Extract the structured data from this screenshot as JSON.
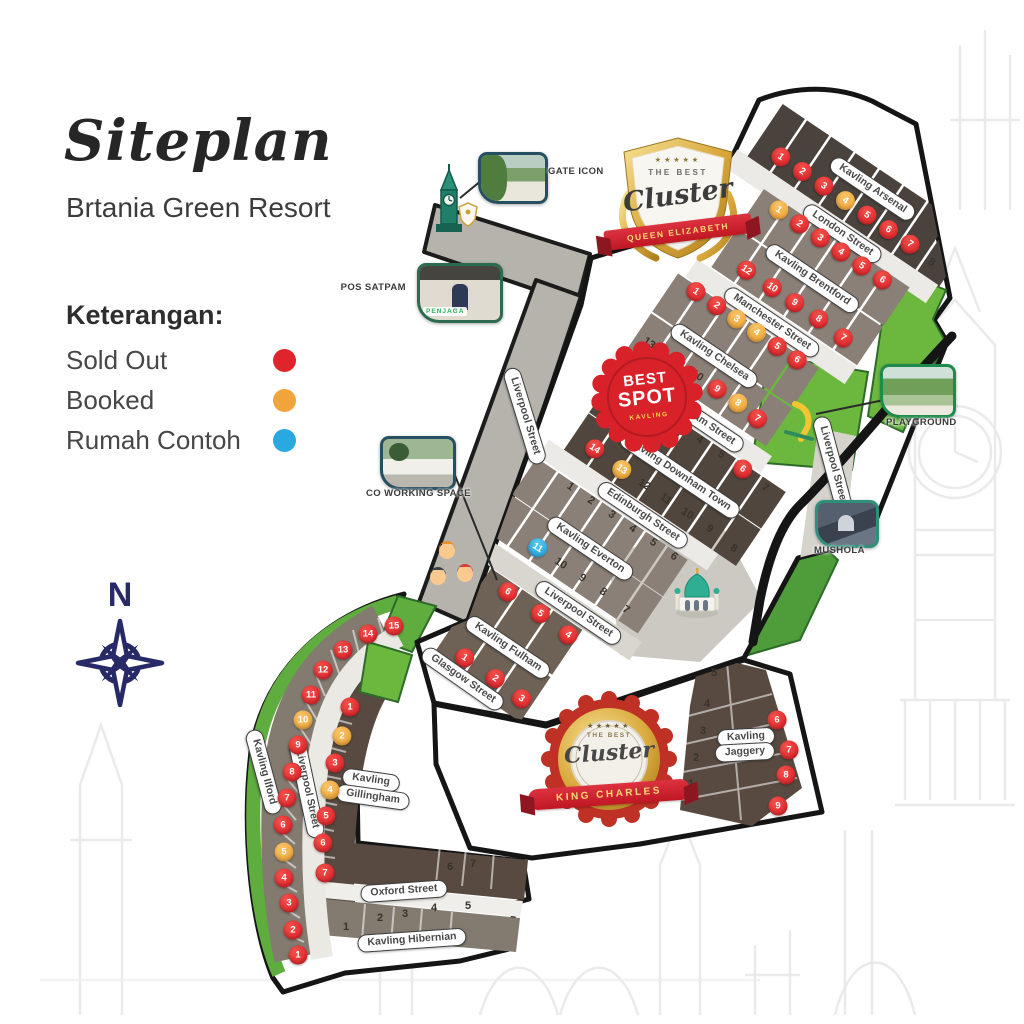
{
  "header": {
    "title": "Siteplan",
    "subtitle": "Brtania Green Resort"
  },
  "legend": {
    "heading": "Keterangan:",
    "items": [
      {
        "label": "Sold Out",
        "status": "sold",
        "color": "#e0242c"
      },
      {
        "label": "Booked",
        "status": "booked",
        "color": "#f1a33c"
      },
      {
        "label": "Rumah Contoh",
        "status": "contoh",
        "color": "#29a9e0"
      }
    ]
  },
  "compass": {
    "north": "N"
  },
  "badges": {
    "queen_elizabeth": {
      "stars": "★★★★★",
      "top_text": "THE BEST",
      "script_text": "Cluster",
      "ribbon_text": "QUEEN ELIZABETH"
    },
    "best_spot": {
      "line1": "BEST",
      "line2": "SPOT",
      "line3": "KAVLING"
    },
    "king_charles": {
      "stars": "★★★★★",
      "top_text": "THE BEST",
      "script_text": "Cluster",
      "ribbon_text": "KING CHARLES"
    }
  },
  "poi": {
    "gate": {
      "label": "GATE ICON"
    },
    "pos_satpam": {
      "label": "POS SATPAM",
      "sign": "PENJAGA"
    },
    "coworking": {
      "label": "CO WORKING SPACE"
    },
    "playground": {
      "label": "PLAYGROUND"
    },
    "mushola": {
      "label": "MUSHOLA"
    }
  },
  "map": {
    "streets": [
      {
        "label": "Kavling Arsenal",
        "frame": "qe",
        "x": 150,
        "y": 12,
        "rot": 0
      },
      {
        "label": "London Street",
        "frame": "qe",
        "x": 150,
        "y": 66,
        "rot": 0
      },
      {
        "label": "Kavling Brentford",
        "frame": "qe",
        "x": 150,
        "y": 120,
        "rot": 0
      },
      {
        "label": "Manchester Street",
        "frame": "qe",
        "x": 141,
        "y": 179,
        "rot": 0
      },
      {
        "label": "Kavling Chelsea",
        "frame": "qe",
        "x": 112,
        "y": 239,
        "rot": 0
      },
      {
        "label": "Birmingham Street",
        "frame": "qe",
        "x": 130,
        "y": 300,
        "rot": 0
      },
      {
        "label": "Kavling Downham Town",
        "frame": "qe",
        "x": 150,
        "y": 357,
        "rot": 0
      },
      {
        "label": "Edinburgh Street",
        "frame": "qe",
        "x": 142,
        "y": 411,
        "rot": 0
      },
      {
        "label": "Kavling Everton",
        "frame": "qe",
        "x": 117,
        "y": 468,
        "rot": 0
      },
      {
        "label": "Liverpool Street",
        "frame": "qe",
        "x": 143,
        "y": 528,
        "rot": 0
      },
      {
        "label": "Kavling Fulham",
        "frame": "qe",
        "x": 104,
        "y": 596,
        "rot": 0
      },
      {
        "label": "Glasgow Street",
        "frame": "abs",
        "x": 463,
        "y": 679,
        "rot": 35
      },
      {
        "label": "Liverpool Street",
        "frame": "abs",
        "x": 525,
        "y": 416,
        "rot": 73
      },
      {
        "label": "Liverpool Street",
        "frame": "abs",
        "x": 833,
        "y": 465,
        "rot": 75
      },
      {
        "label": "Kavling Ilford",
        "frame": "abs",
        "x": 264,
        "y": 772,
        "rot": 75
      },
      {
        "label": "Liverpool Street",
        "frame": "abs",
        "x": 307,
        "y": 789,
        "rot": 78
      },
      {
        "label": "Kavling",
        "frame": "abs",
        "x": 371,
        "y": 780,
        "rot": 8
      },
      {
        "label": "Gillingham",
        "frame": "abs",
        "x": 373,
        "y": 797,
        "rot": 8
      },
      {
        "label": "Oxford Street",
        "frame": "abs",
        "x": 404,
        "y": 891,
        "rot": -4
      },
      {
        "label": "Kavling Hibernian",
        "frame": "abs",
        "x": 412,
        "y": 940,
        "rot": -4
      },
      {
        "label": "Kavling",
        "frame": "abs",
        "x": 746,
        "y": 737,
        "rot": -3
      },
      {
        "label": "Jaggery",
        "frame": "abs",
        "x": 745,
        "y": 752,
        "rot": -3
      }
    ],
    "plot_groups": [
      {
        "id": "arsenal",
        "kavling": "Kavling Arsenal",
        "frame": "qe",
        "markers": [
          {
            "n": "1",
            "s": "sold",
            "x": 56,
            "y": 37
          },
          {
            "n": "2",
            "s": "sold",
            "x": 82,
            "y": 37
          },
          {
            "n": "3",
            "s": "sold",
            "x": 108,
            "y": 37
          },
          {
            "n": "4",
            "s": "booked",
            "x": 134,
            "y": 37
          },
          {
            "n": "5",
            "s": "sold",
            "x": 160,
            "y": 37
          },
          {
            "n": "6",
            "s": "sold",
            "x": 186,
            "y": 37
          },
          {
            "n": "7",
            "s": "sold",
            "x": 212,
            "y": 37
          },
          {
            "n": "8",
            "s": "open",
            "x": 240,
            "y": 40
          }
        ]
      },
      {
        "id": "brentford",
        "kavling": "Kavling Brentford",
        "frame": "qe",
        "markers": [
          {
            "n": "1",
            "s": "booked",
            "x": 84,
            "y": 82
          },
          {
            "n": "2",
            "s": "sold",
            "x": 109,
            "y": 82
          },
          {
            "n": "3",
            "s": "sold",
            "x": 134,
            "y": 82
          },
          {
            "n": "4",
            "s": "sold",
            "x": 159,
            "y": 82
          },
          {
            "n": "5",
            "s": "sold",
            "x": 184,
            "y": 82
          },
          {
            "n": "6",
            "s": "sold",
            "x": 209,
            "y": 82
          },
          {
            "n": "12",
            "s": "sold",
            "x": 91,
            "y": 150
          },
          {
            "n": "10",
            "s": "sold",
            "x": 122,
            "y": 150
          },
          {
            "n": "9",
            "s": "sold",
            "x": 149,
            "y": 150
          },
          {
            "n": "8",
            "s": "sold",
            "x": 178,
            "y": 150
          },
          {
            "n": "7",
            "s": "sold",
            "x": 209,
            "y": 152
          }
        ]
      },
      {
        "id": "chelsea",
        "kavling": "Kavling Chelsea",
        "frame": "qe",
        "markers": [
          {
            "n": "1",
            "s": "sold",
            "x": 61,
            "y": 196
          },
          {
            "n": "2",
            "s": "sold",
            "x": 86,
            "y": 196
          },
          {
            "n": "3",
            "s": "booked",
            "x": 110,
            "y": 196
          },
          {
            "n": "4",
            "s": "booked",
            "x": 134,
            "y": 196
          },
          {
            "n": "5",
            "s": "sold",
            "x": 159,
            "y": 196
          },
          {
            "n": "6",
            "s": "sold",
            "x": 183,
            "y": 196
          },
          {
            "n": "13",
            "s": "open",
            "x": 51,
            "y": 265
          },
          {
            "n": "10",
            "s": "open",
            "x": 109,
            "y": 265
          },
          {
            "n": "9",
            "s": "sold",
            "x": 133,
            "y": 265
          },
          {
            "n": "8",
            "s": "booked",
            "x": 158,
            "y": 265
          },
          {
            "n": "7",
            "s": "sold",
            "x": 183,
            "y": 267
          }
        ]
      },
      {
        "id": "downham",
        "kavling": "Kavling Downham Town",
        "frame": "qe",
        "markers": [
          {
            "n": "3",
            "s": "open",
            "x": 121,
            "y": 317
          },
          {
            "n": "4",
            "s": "open",
            "x": 147,
            "y": 317
          },
          {
            "n": "5",
            "s": "open",
            "x": 173,
            "y": 317
          },
          {
            "n": "6",
            "s": "sold",
            "x": 199,
            "y": 317
          },
          {
            "n": "7",
            "s": "open",
            "x": 228,
            "y": 320
          },
          {
            "n": "14",
            "s": "sold",
            "x": 65,
            "y": 383
          },
          {
            "n": "13",
            "s": "booked",
            "x": 99,
            "y": 385
          },
          {
            "n": "12",
            "s": "open",
            "x": 126,
            "y": 385
          },
          {
            "n": "11",
            "s": "open",
            "x": 152,
            "y": 385
          },
          {
            "n": "10",
            "s": "open",
            "x": 178,
            "y": 385
          },
          {
            "n": "9",
            "s": "open",
            "x": 205,
            "y": 385
          },
          {
            "n": "8",
            "s": "open",
            "x": 236,
            "y": 388
          }
        ]
      },
      {
        "id": "everton",
        "kavling": "Kavling Everton",
        "frame": "qe",
        "markers": [
          {
            "n": "1",
            "s": "open",
            "x": 66,
            "y": 428
          },
          {
            "n": "2",
            "s": "open",
            "x": 91,
            "y": 428
          },
          {
            "n": "3",
            "s": "open",
            "x": 116,
            "y": 428
          },
          {
            "n": "4",
            "s": "open",
            "x": 141,
            "y": 428
          },
          {
            "n": "5",
            "s": "open",
            "x": 166,
            "y": 428
          },
          {
            "n": "6",
            "s": "open",
            "x": 191,
            "y": 428
          },
          {
            "n": "11",
            "s": "contoh",
            "x": 73,
            "y": 497
          },
          {
            "n": "10",
            "s": "open",
            "x": 101,
            "y": 497
          },
          {
            "n": "9",
            "s": "open",
            "x": 127,
            "y": 497
          },
          {
            "n": "8",
            "s": "open",
            "x": 152,
            "y": 497
          },
          {
            "n": "7",
            "s": "open",
            "x": 181,
            "y": 499
          }
        ]
      },
      {
        "id": "fulham",
        "kavling": "Kavling Fulham",
        "frame": "qe",
        "markers": [
          {
            "n": "6",
            "s": "sold",
            "x": 73,
            "y": 550
          },
          {
            "n": "5",
            "s": "sold",
            "x": 112,
            "y": 550
          },
          {
            "n": "4",
            "s": "sold",
            "x": 147,
            "y": 552
          },
          {
            "n": "1",
            "s": "sold",
            "x": 74,
            "y": 629
          },
          {
            "n": "2",
            "s": "sold",
            "x": 111,
            "y": 629
          },
          {
            "n": "3",
            "s": "sold",
            "x": 144,
            "y": 631
          }
        ]
      },
      {
        "id": "ilford",
        "kavling": "Kavling Ilford",
        "frame": "abs",
        "markers": [
          {
            "n": "15",
            "s": "sold",
            "x": 394,
            "y": 626
          },
          {
            "n": "14",
            "s": "sold",
            "x": 368,
            "y": 634
          },
          {
            "n": "13",
            "s": "sold",
            "x": 343,
            "y": 650
          },
          {
            "n": "12",
            "s": "sold",
            "x": 323,
            "y": 670
          },
          {
            "n": "11",
            "s": "sold",
            "x": 311,
            "y": 695
          },
          {
            "n": "10",
            "s": "booked",
            "x": 303,
            "y": 720
          },
          {
            "n": "9",
            "s": "sold",
            "x": 298,
            "y": 745
          },
          {
            "n": "8",
            "s": "sold",
            "x": 292,
            "y": 772
          },
          {
            "n": "7",
            "s": "sold",
            "x": 287,
            "y": 798
          },
          {
            "n": "6",
            "s": "sold",
            "x": 283,
            "y": 825
          },
          {
            "n": "5",
            "s": "booked",
            "x": 284,
            "y": 852
          },
          {
            "n": "4",
            "s": "sold",
            "x": 284,
            "y": 878
          },
          {
            "n": "3",
            "s": "sold",
            "x": 289,
            "y": 903
          },
          {
            "n": "2",
            "s": "sold",
            "x": 293,
            "y": 930
          },
          {
            "n": "1",
            "s": "sold",
            "x": 298,
            "y": 955
          }
        ]
      },
      {
        "id": "gillingham",
        "kavling": "Kavling Gillingham",
        "frame": "abs",
        "markers": [
          {
            "n": "1",
            "s": "sold",
            "x": 350,
            "y": 707
          },
          {
            "n": "2",
            "s": "booked",
            "x": 342,
            "y": 736
          },
          {
            "n": "3",
            "s": "sold",
            "x": 335,
            "y": 763
          },
          {
            "n": "4",
            "s": "booked",
            "x": 330,
            "y": 790
          },
          {
            "n": "5",
            "s": "sold",
            "x": 326,
            "y": 816
          },
          {
            "n": "6",
            "s": "sold",
            "x": 323,
            "y": 843
          },
          {
            "n": "7",
            "s": "sold",
            "x": 325,
            "y": 873
          }
        ]
      },
      {
        "id": "hibernian",
        "kavling": "Kavling Hibernian",
        "frame": "abs",
        "markers": [
          {
            "n": "6",
            "s": "open",
            "x": 450,
            "y": 867
          },
          {
            "n": "7",
            "s": "open",
            "x": 473,
            "y": 864
          },
          {
            "n": "1",
            "s": "open",
            "x": 346,
            "y": 927
          },
          {
            "n": "2",
            "s": "open",
            "x": 380,
            "y": 918
          },
          {
            "n": "3",
            "s": "open",
            "x": 405,
            "y": 914
          },
          {
            "n": "4",
            "s": "open",
            "x": 434,
            "y": 908
          },
          {
            "n": "5",
            "s": "open",
            "x": 468,
            "y": 906
          }
        ]
      },
      {
        "id": "jaggery",
        "kavling": "Kavling Jaggery",
        "frame": "abs",
        "markers": [
          {
            "n": "5",
            "s": "open",
            "x": 714,
            "y": 673
          },
          {
            "n": "4",
            "s": "open",
            "x": 707,
            "y": 704
          },
          {
            "n": "3",
            "s": "open",
            "x": 703,
            "y": 731
          },
          {
            "n": "2",
            "s": "open",
            "x": 696,
            "y": 758
          },
          {
            "n": "1",
            "s": "open",
            "x": 691,
            "y": 784
          },
          {
            "n": "6",
            "s": "sold",
            "x": 777,
            "y": 720
          },
          {
            "n": "7",
            "s": "sold",
            "x": 789,
            "y": 750
          },
          {
            "n": "8",
            "s": "sold",
            "x": 786,
            "y": 775
          },
          {
            "n": "9",
            "s": "sold",
            "x": 778,
            "y": 806
          }
        ]
      }
    ]
  }
}
